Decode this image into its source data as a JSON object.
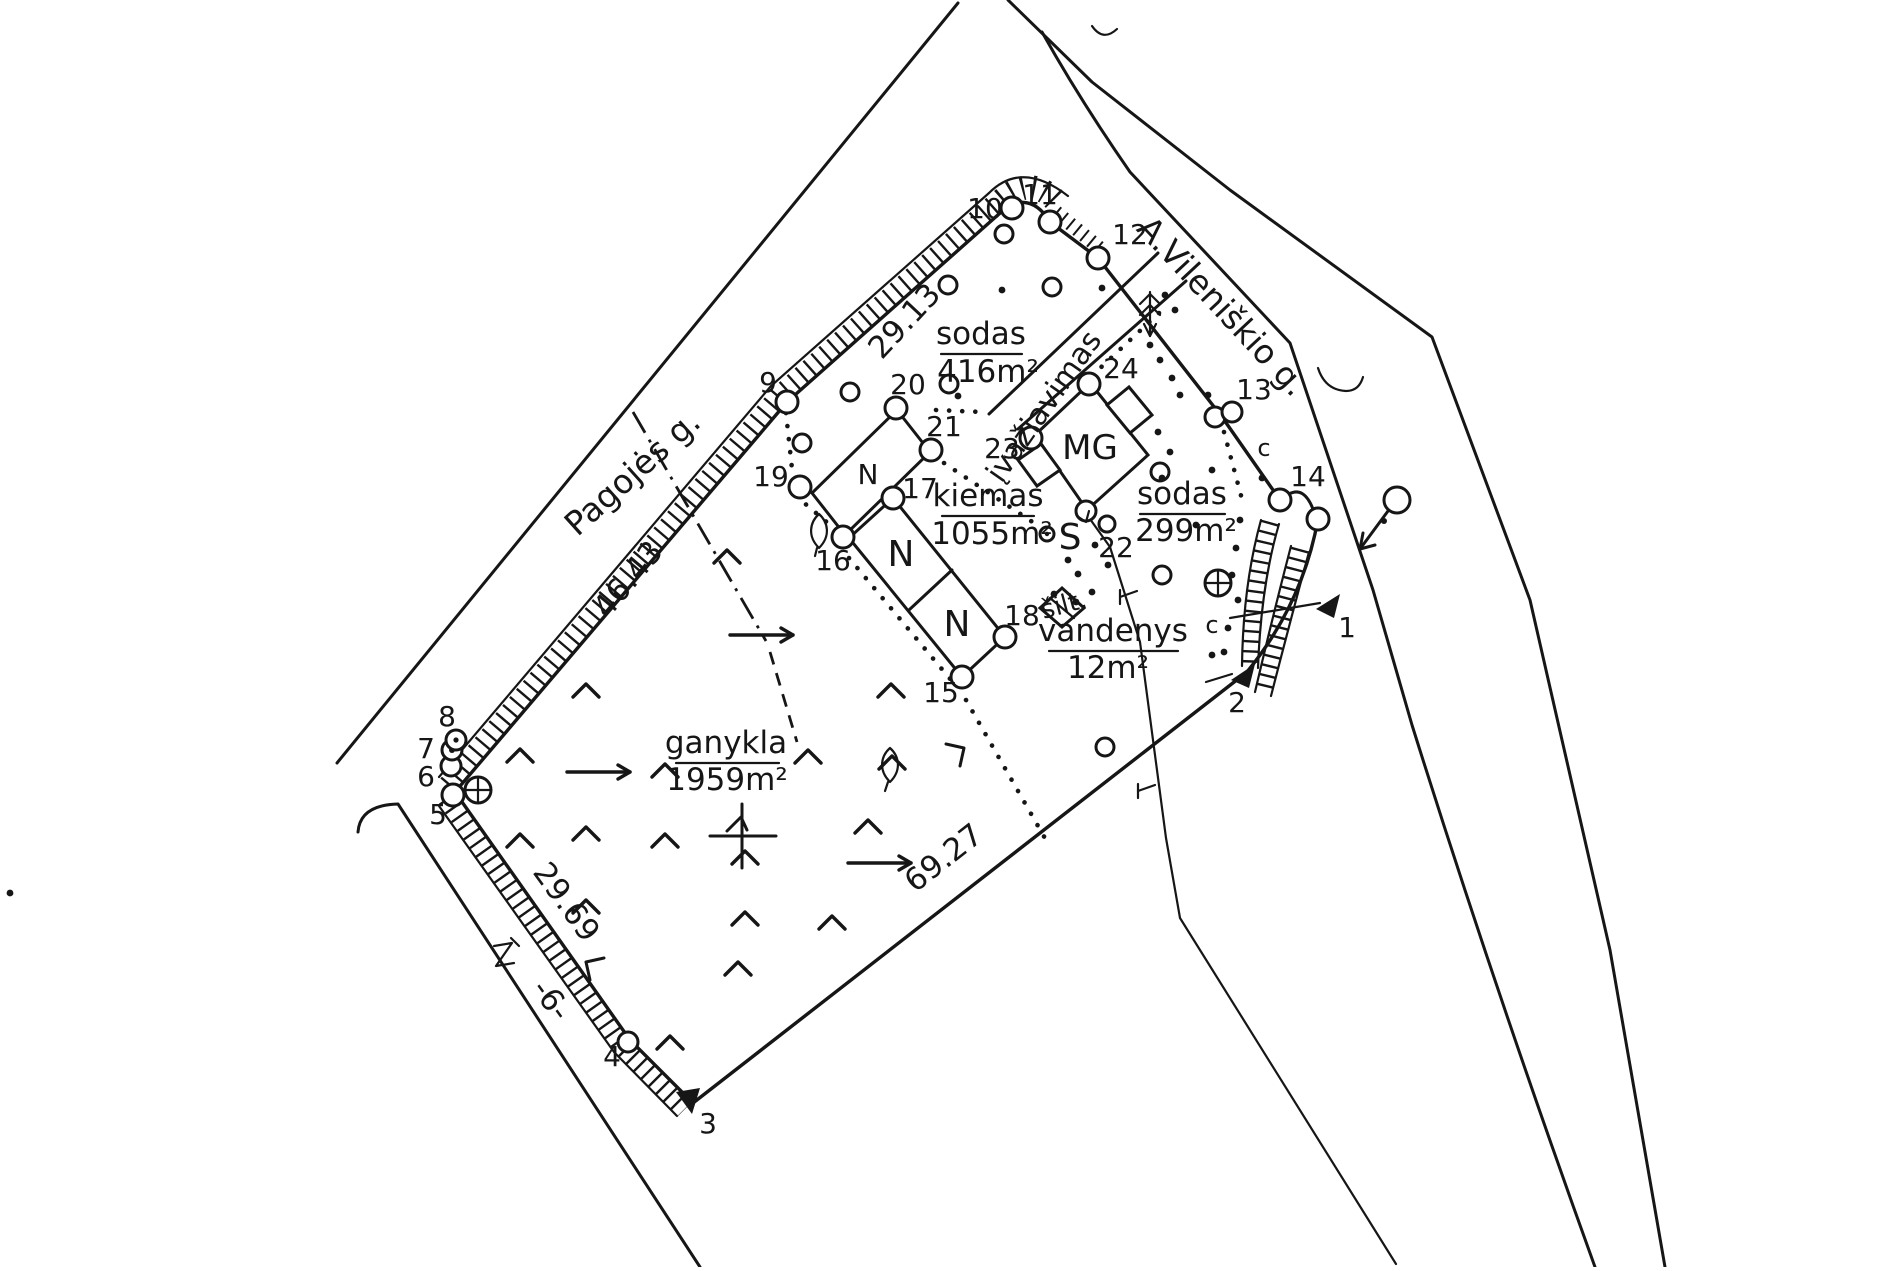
{
  "streets": {
    "left": "Pagojės g.",
    "right": "A.Vileniškio g."
  },
  "measurements": {
    "nw_fence": "29.13",
    "w_fence": "46.43",
    "sw_fence": "29.69",
    "se_boundary": "69.27",
    "road_code": "-6-"
  },
  "areas": {
    "sodas_north": {
      "label": "sodas",
      "area": "416m²"
    },
    "kiemas": {
      "label": "kiemas",
      "area": "1055m²"
    },
    "sodas_east": {
      "label": "sodas",
      "area": "299m²"
    },
    "ganykla": {
      "label": "ganykla",
      "area": "1959m²"
    },
    "vandenys": {
      "label": "vandenys",
      "area": "12m²"
    },
    "driveway": {
      "label": "įvažiavimas"
    }
  },
  "buildings": {
    "house1": "N",
    "house2": "N",
    "house3": "N",
    "garage": "MG",
    "greenhouse": "šilt.",
    "well": "S"
  },
  "points": {
    "p1": "1",
    "p2": "2",
    "p3": "3",
    "p4": "4",
    "p5": "5",
    "p6": "6",
    "p7": "7",
    "p8": "8",
    "p9": "9",
    "p10": "10",
    "p11": "11",
    "p12": "12",
    "p13": "13",
    "p14": "14",
    "p15": "15",
    "p16": "16",
    "p17": "17",
    "p18": "18",
    "p19": "19",
    "p20": "20",
    "p21": "21",
    "p22": "22",
    "p23": "23",
    "p24": "24"
  },
  "marks": {
    "c_upper": "c",
    "c_lower": "c"
  }
}
